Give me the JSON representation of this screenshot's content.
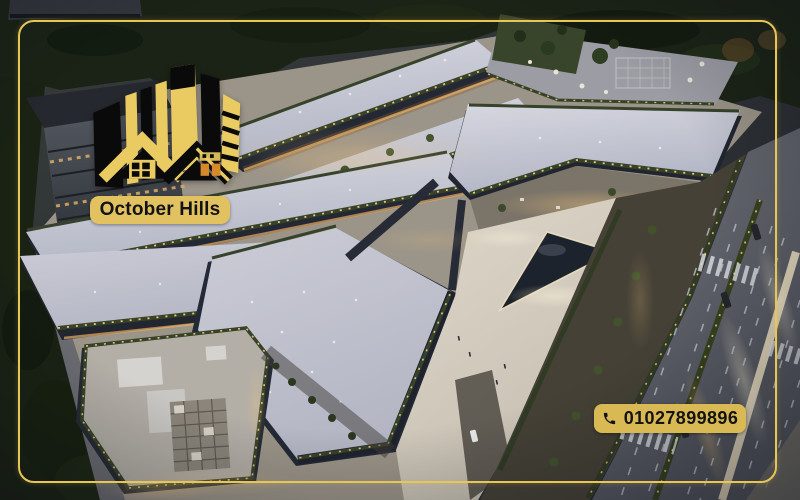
{
  "brand": {
    "name": "October Hills"
  },
  "contact": {
    "phone": "01027899896"
  },
  "theme": {
    "frame_gold": "#e7c655",
    "brand_badge_gold": "#e2c161",
    "phone_badge_gold": "#d8b954",
    "logo_gold": "#e9cb62",
    "logo_black": "#0a0a0b",
    "logo_orange": "#d6892b",
    "text_color": "#131313"
  }
}
